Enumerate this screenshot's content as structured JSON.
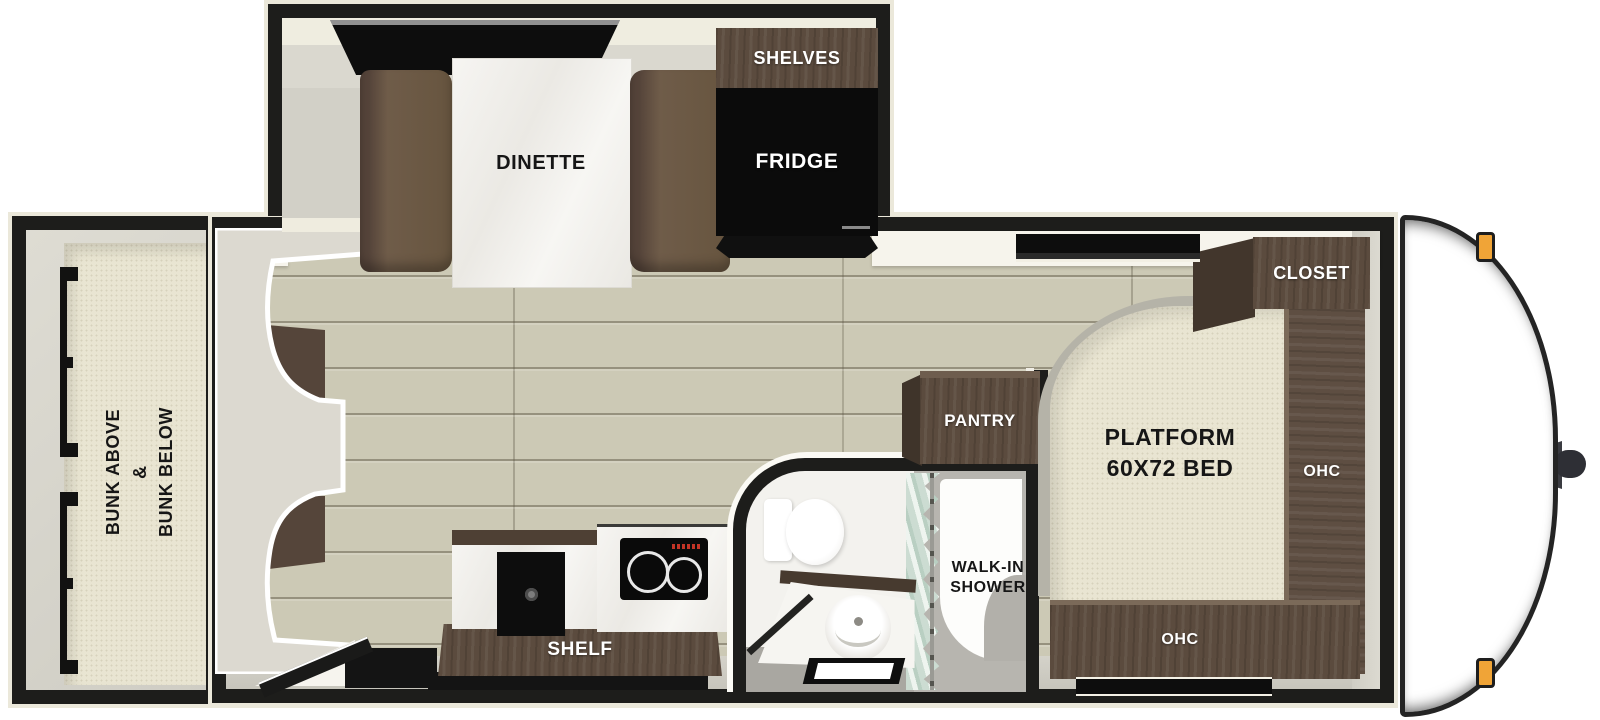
{
  "diagram": {
    "type": "travel-trailer-floorplan",
    "labels": {
      "dinette": "DINETTE",
      "shelves": "SHELVES",
      "fridge": "FRIDGE",
      "bunk": [
        "BUNK ABOVE",
        "&",
        "BUNK BELOW"
      ],
      "shelf": "SHELF",
      "walk_in_shower": [
        "WALK-IN",
        "SHOWER"
      ],
      "pantry": "PANTRY",
      "closet": "CLOSET",
      "bed": [
        "PLATFORM",
        "60X72 BED"
      ],
      "ohc_right": "OHC",
      "ohc_bottom": "OHC"
    },
    "colors": {
      "wall": "#1d1d1b",
      "trim": "#ebe8da",
      "wood_floor": "#ccc9b5",
      "cabinet_wood": "#5b4b3e",
      "bench_brown": "#6c5946",
      "mattress_beige": "#e9e5d2",
      "marker_light_amber": "#f0a437",
      "shower_curtain_green": "#ccdcd2",
      "bathroom_floor_gray": "#a9a7a1"
    }
  }
}
